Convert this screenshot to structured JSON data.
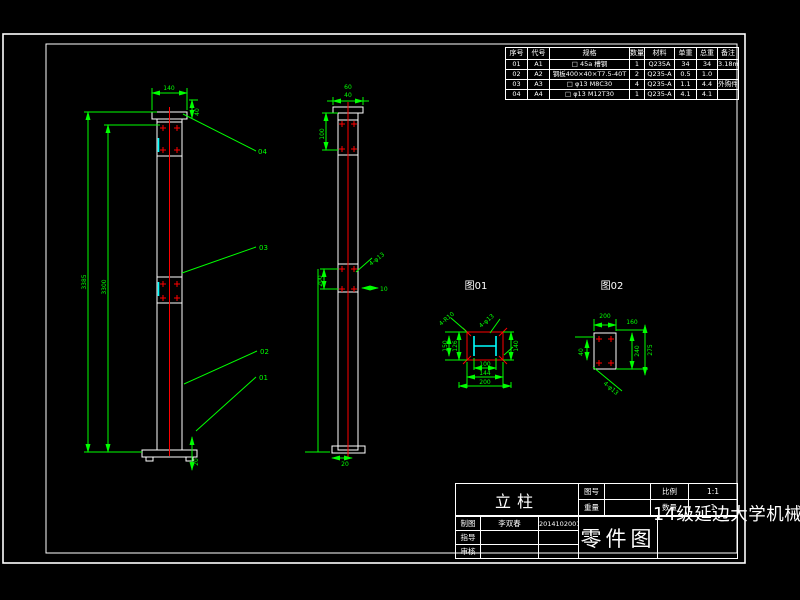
{
  "colors": {
    "background": "#000000",
    "dimension_green": "#00ff00",
    "centerline_red": "#ff0000",
    "section_cyan": "#00ffff",
    "outline_white": "#ffffff"
  },
  "bom": {
    "headers": [
      "序号",
      "代号",
      "规格",
      "数量",
      "材料",
      "单重",
      "总重",
      "备注"
    ],
    "rows": [
      [
        "01",
        "A1",
        "□ 45a 槽钢",
        "1",
        "Q235A",
        "34",
        "34",
        "3.18m"
      ],
      [
        "02",
        "A2",
        "钢板400×40×T7.5-40T",
        "2",
        "Q235-A",
        "0.5",
        "1.0",
        ""
      ],
      [
        "03",
        "A3",
        "□ φ13 M8C30",
        "4",
        "Q235-A",
        "1.1",
        "4.4",
        "外购件"
      ],
      [
        "04",
        "A4",
        "□ φ13 M12T30",
        "1",
        "Q235-A",
        "4.1",
        "4.1",
        ""
      ]
    ]
  },
  "title_block": {
    "part_name": "立柱",
    "drawing_no_label": "图号",
    "drawing_no_value": "",
    "weight_label": "重量",
    "weight_value": "",
    "scale_label": "比例",
    "scale_value": "1:1",
    "qty_label": "数量",
    "qty_value": "1",
    "drawn_label": "制图",
    "drawn_name": "李双春",
    "drawn_id": "2014102001",
    "advisor_label": "指导",
    "checker_label": "审核",
    "doc_type": "零件图",
    "school": "14级延边大学机械系"
  },
  "front_view": {
    "balloons": [
      "04",
      "03",
      "02",
      "01"
    ],
    "dims": {
      "top_width": "140",
      "top_side": "40",
      "height_total": "3385",
      "height_inner": "3300",
      "base": "20"
    }
  },
  "side_view": {
    "dims": {
      "top1": "60",
      "top2": "40",
      "upper_left": "100",
      "mid_left": "200",
      "mid_right": "10",
      "mid_diag": "4-φ13",
      "base": "20"
    }
  },
  "figures": {
    "fig01": {
      "label": "图01",
      "dims": {
        "left1": "126",
        "left2": "150",
        "right": "140",
        "bottom1": "100",
        "bottom2": "144",
        "bottom3": "200",
        "leader_left": "4-R10",
        "leader_right": "4-φ13"
      }
    },
    "fig02": {
      "label": "图02",
      "dims": {
        "top": "200",
        "top_right": "160",
        "right1": "240",
        "right2": "275",
        "left": "40",
        "leader": "4-φ13"
      }
    }
  }
}
